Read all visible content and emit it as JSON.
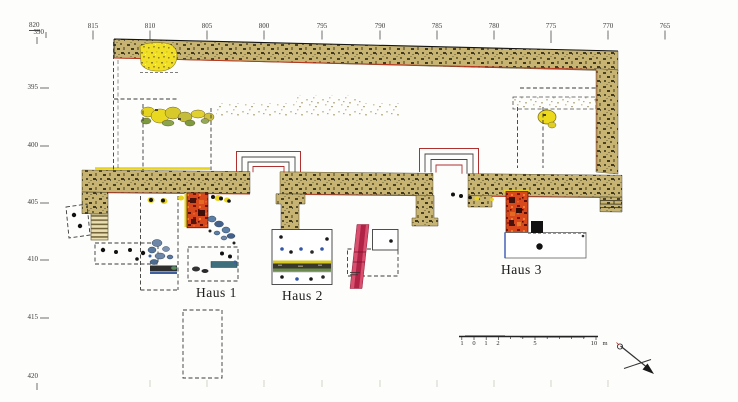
{
  "figure": {
    "type": "archaeological excavation site plan",
    "houses": [
      {
        "label": "Haus 1"
      },
      {
        "label": "Haus 2"
      },
      {
        "label": "Haus 3"
      }
    ]
  },
  "axes": {
    "top": {
      "labels": [
        "820",
        "815",
        "810",
        "805",
        "800",
        "795",
        "790",
        "785",
        "780",
        "775",
        "770",
        "765"
      ]
    },
    "left": {
      "labels": [
        "390",
        "395",
        "400",
        "405",
        "410",
        "415",
        "420"
      ]
    }
  },
  "scale_bar": {
    "labels": [
      "1",
      "0",
      "1",
      "2",
      "5",
      "10"
    ],
    "unit": "m"
  },
  "symbols": {
    "north_arrow": "north-arrow"
  },
  "colors": {
    "wall_masonry": "#c7b472",
    "hearth_red": "#d7491c",
    "find_yellow": "#f0df24",
    "stripe_pink": "#d94f6e",
    "stone_blue": "#5c7fa6",
    "plan_red_edge": "#b83822"
  }
}
